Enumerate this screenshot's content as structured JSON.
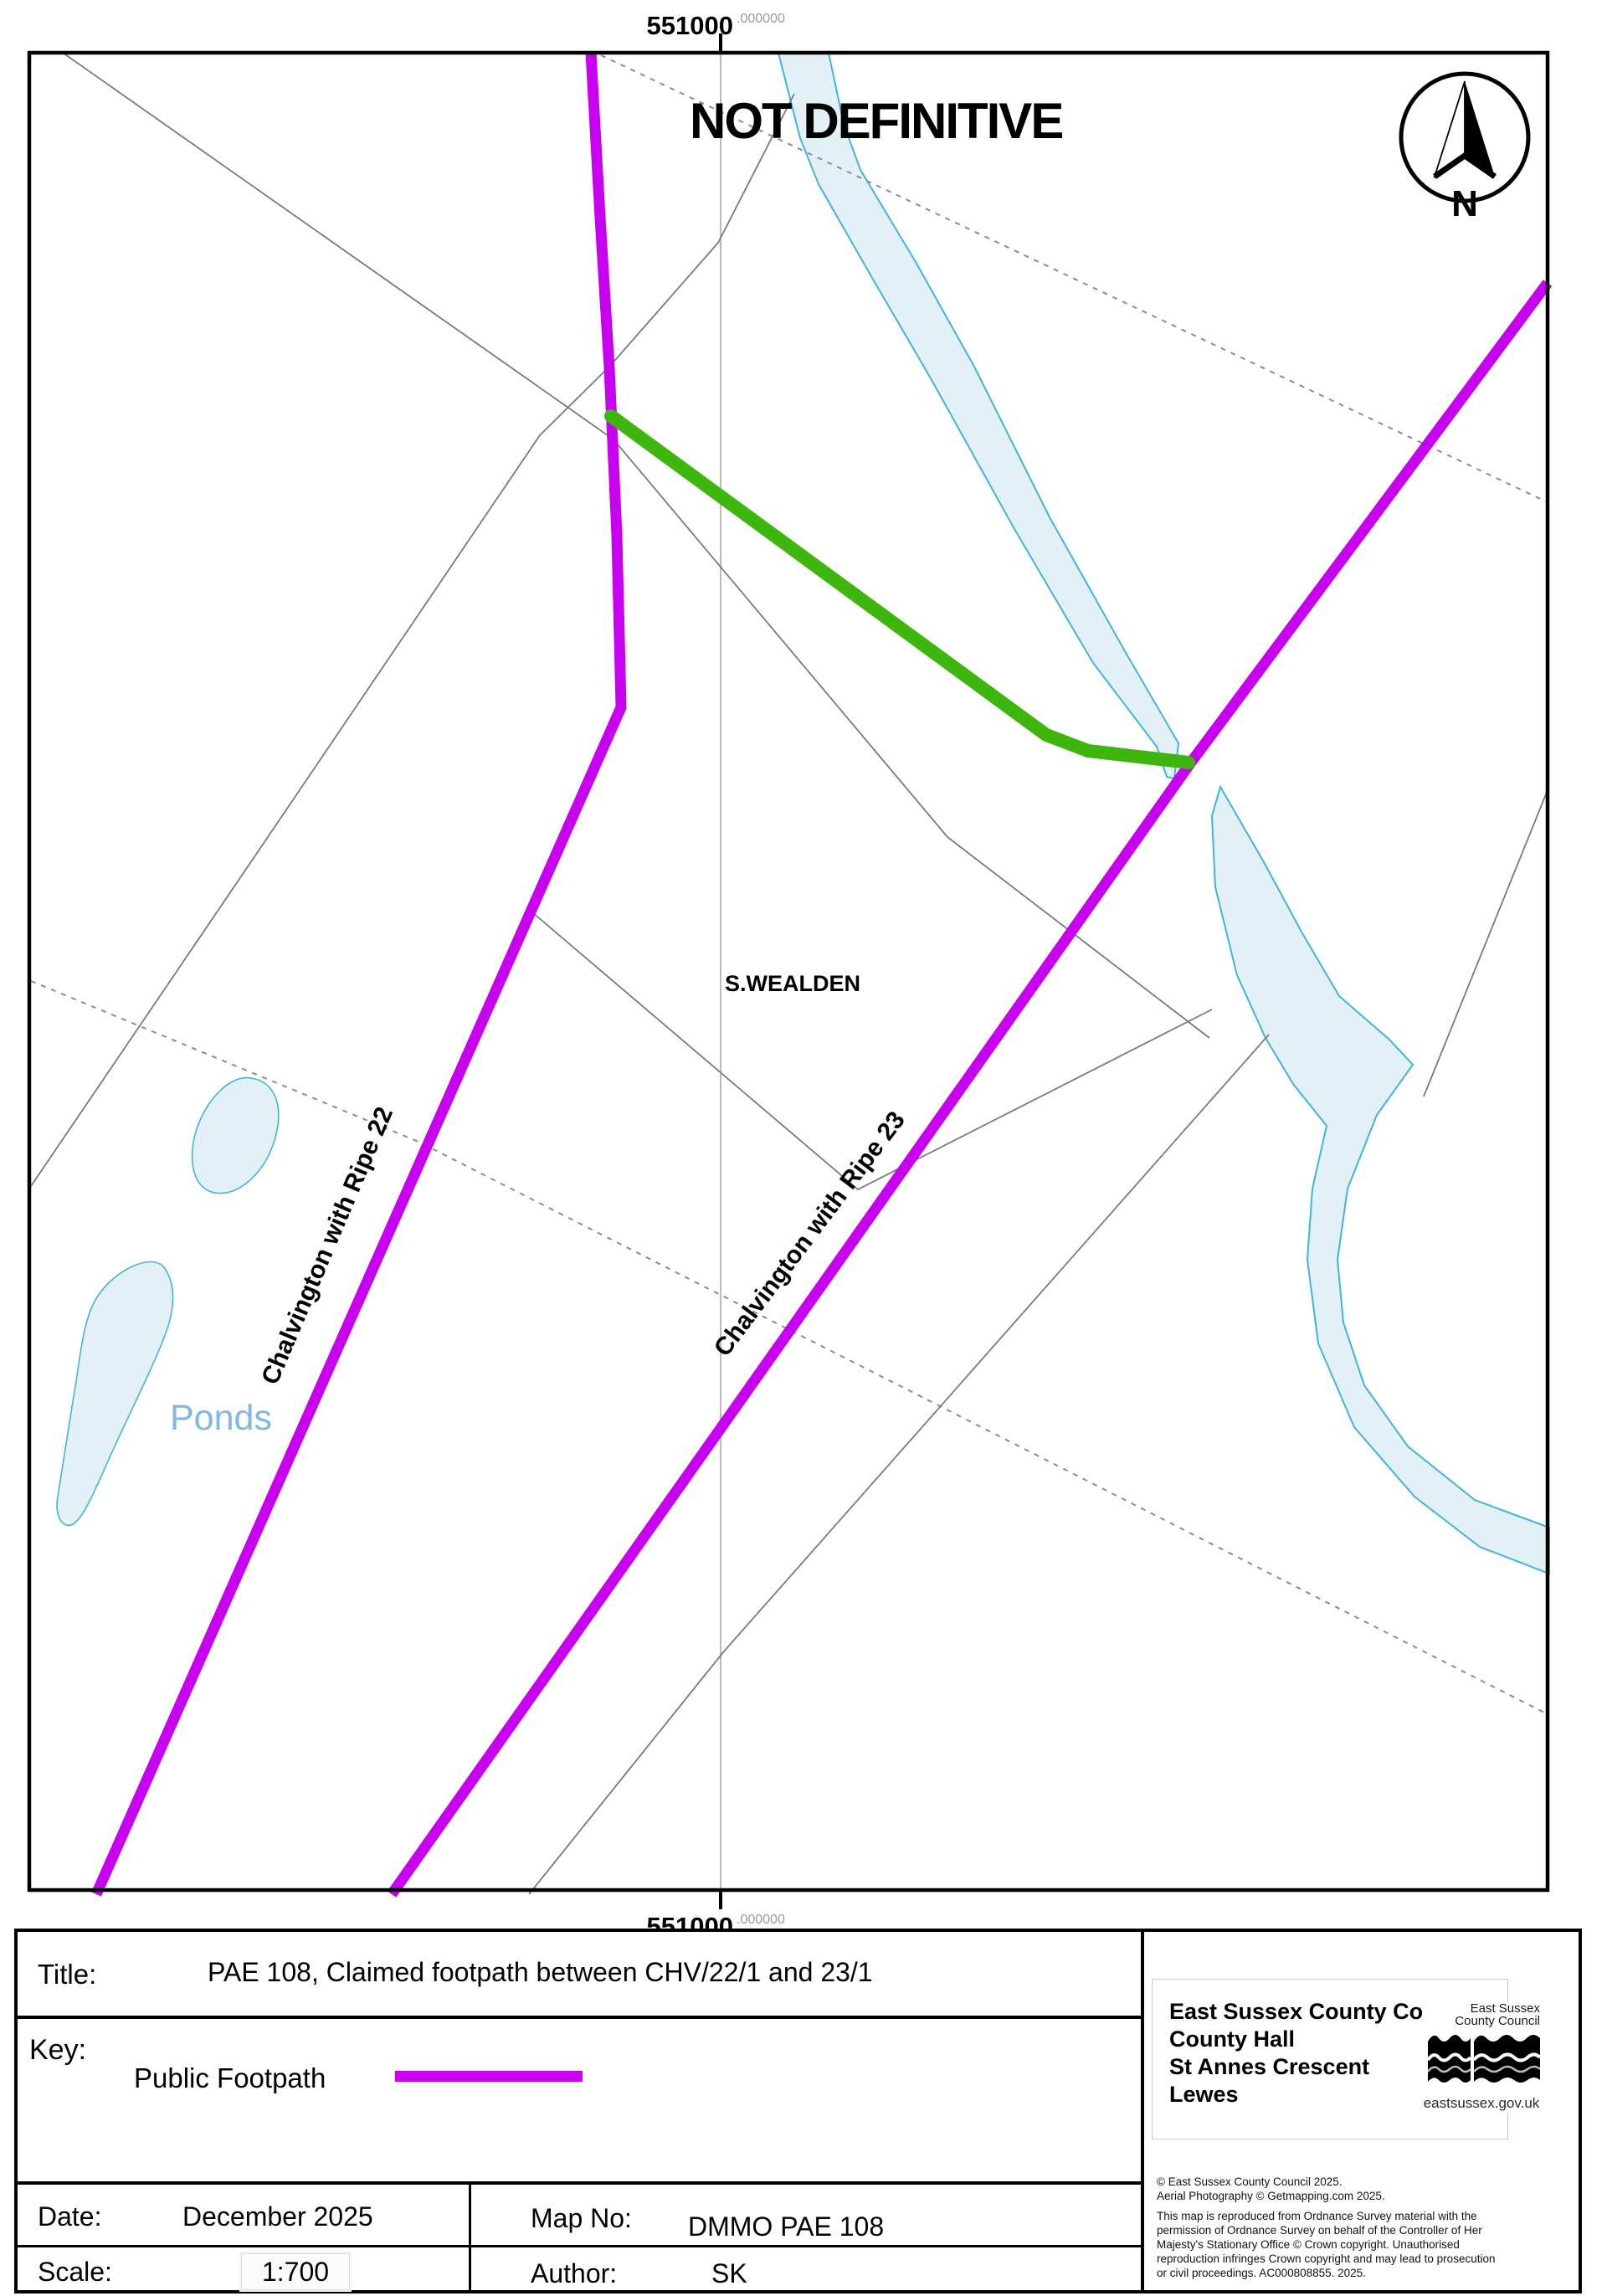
{
  "colors": {
    "magenta": "#c900f0",
    "green": "#3fb60e",
    "water_fill": "#e3f1f7",
    "water_stroke": "#3fb5de",
    "ponds_text": "#7fb8e8",
    "gray_line": "#7a7a7a",
    "dash_line": "#8c8c8c",
    "grid_line": "#a3a3a3"
  },
  "map": {
    "watermark": "NOT DEFINITIVE",
    "compass_letter": "N",
    "top_coordinate": {
      "main": "551000",
      "decimal": ".000000"
    },
    "bottom_coordinate": {
      "main": "551000",
      "decimal": ".000000"
    },
    "labels": {
      "district": "S.WEALDEN",
      "ponds": "Ponds",
      "path22": "Chalvington with Ripe 22",
      "path23": "Chalvington with Ripe 23"
    }
  },
  "footer": {
    "title_label": "Title:",
    "title": "PAE 108, Claimed footpath between CHV/22/1 and 23/1",
    "key_label": "Key:",
    "key_item": "Public Footpath",
    "date_label": "Date:",
    "date": "December 2025",
    "map_no_label": "Map No:",
    "map_no": "DMMO PAE 108",
    "scale_label": "Scale:",
    "scale": "1:700",
    "author_label": "Author:",
    "author": "SK",
    "address": {
      "lines": [
        "East Sussex County Council",
        "County Hall",
        "St Annes Crescent",
        "Lewes"
      ]
    },
    "logo": {
      "line1": "East Sussex",
      "line2": "County Council",
      "url": "eastsussex.gov.uk"
    },
    "copyright": {
      "lines": [
        "© East Sussex County Council 2025.",
        "Aerial Photography © Getmapping.com 2025.",
        "This map is reproduced from Ordnance Survey material with the",
        "permission of Ordnance Survey on behalf of the Controller of Her",
        "Majesty's Stationary Office © Crown copyright. Unauthorised",
        "reproduction infringes Crown copyright and may lead to prosecution",
        "or civil proceedings. AC000808855. 2025."
      ]
    }
  }
}
